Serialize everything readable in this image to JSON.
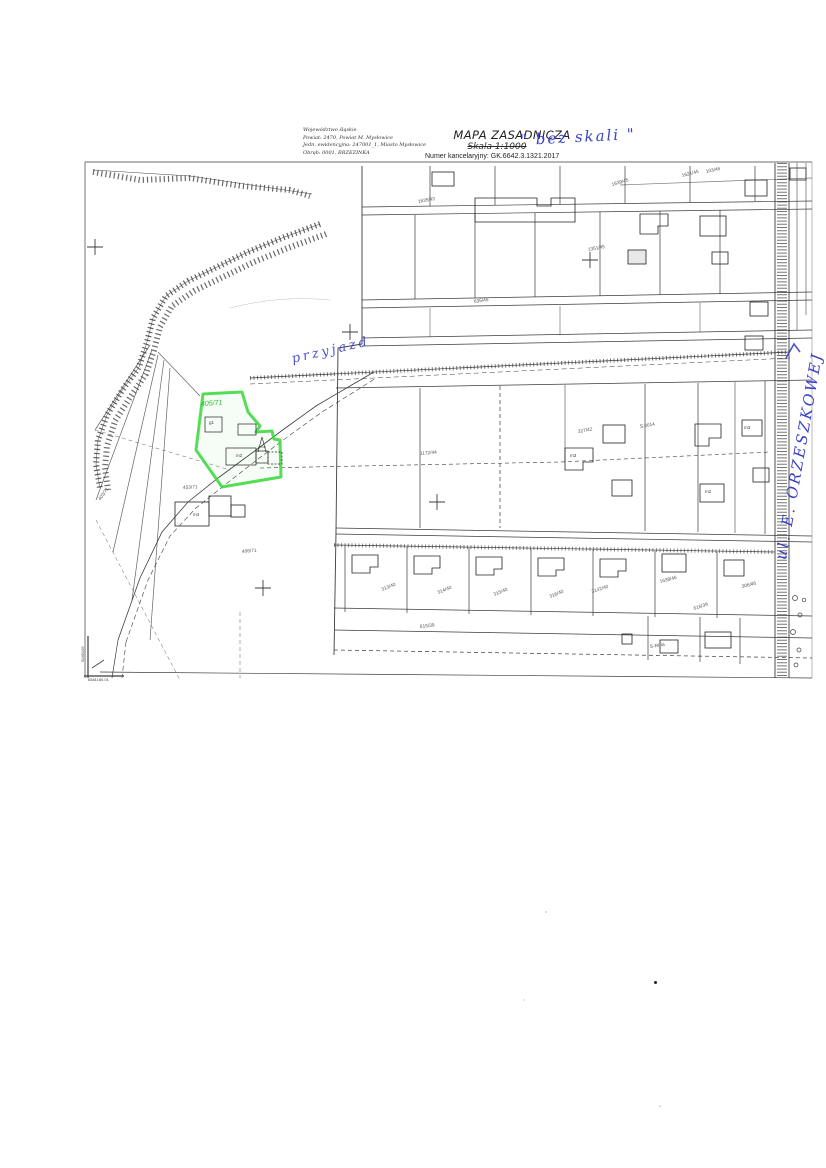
{
  "header": {
    "left_block": {
      "line1": "Województwo śląskie",
      "line2": "Powiat: 2470, Powiat M. Mysłowice",
      "line3": "Jedn. ewidencyjna: 247001_1, Miasto Mysłowice",
      "line4": "Obręb: 0001, BRZEZINKA"
    },
    "title": "MAPA ZASADNICZA",
    "scale_label": "Skala 1:1000",
    "scale_handwritten": "\" bez skali \"",
    "registry_number": "Numer kancelaryjny: GK.6642.3.1321.2017"
  },
  "map": {
    "colors": {
      "highlight_green": "#39d839",
      "ink_blue": "#3a41c9"
    },
    "green_parcel_number": "405/71",
    "handwritten": {
      "road_annotation": "przyjazd",
      "street_name": "ul. E. ORZESZKOWEJ"
    },
    "corner_coords": {
      "horizontal": "6581160.01",
      "vertical": "5046105"
    },
    "parcel_labels": [
      "1635/43",
      "635/45",
      "1639/45",
      "1621/45",
      "1351/45",
      "103/46",
      "327/42",
      "1172/44",
      "313/40",
      "314/40",
      "315/40",
      "316/40",
      "3142/40",
      "1638/46",
      "306/46",
      "615/39",
      "615/39",
      "406/71",
      "453/71",
      "403/71"
    ],
    "building_labels": [
      "g1",
      "m3",
      "m2",
      "m3",
      "m2",
      "m3"
    ],
    "land_use_labels": [
      "S.0014",
      "S-RIIIa"
    ]
  }
}
